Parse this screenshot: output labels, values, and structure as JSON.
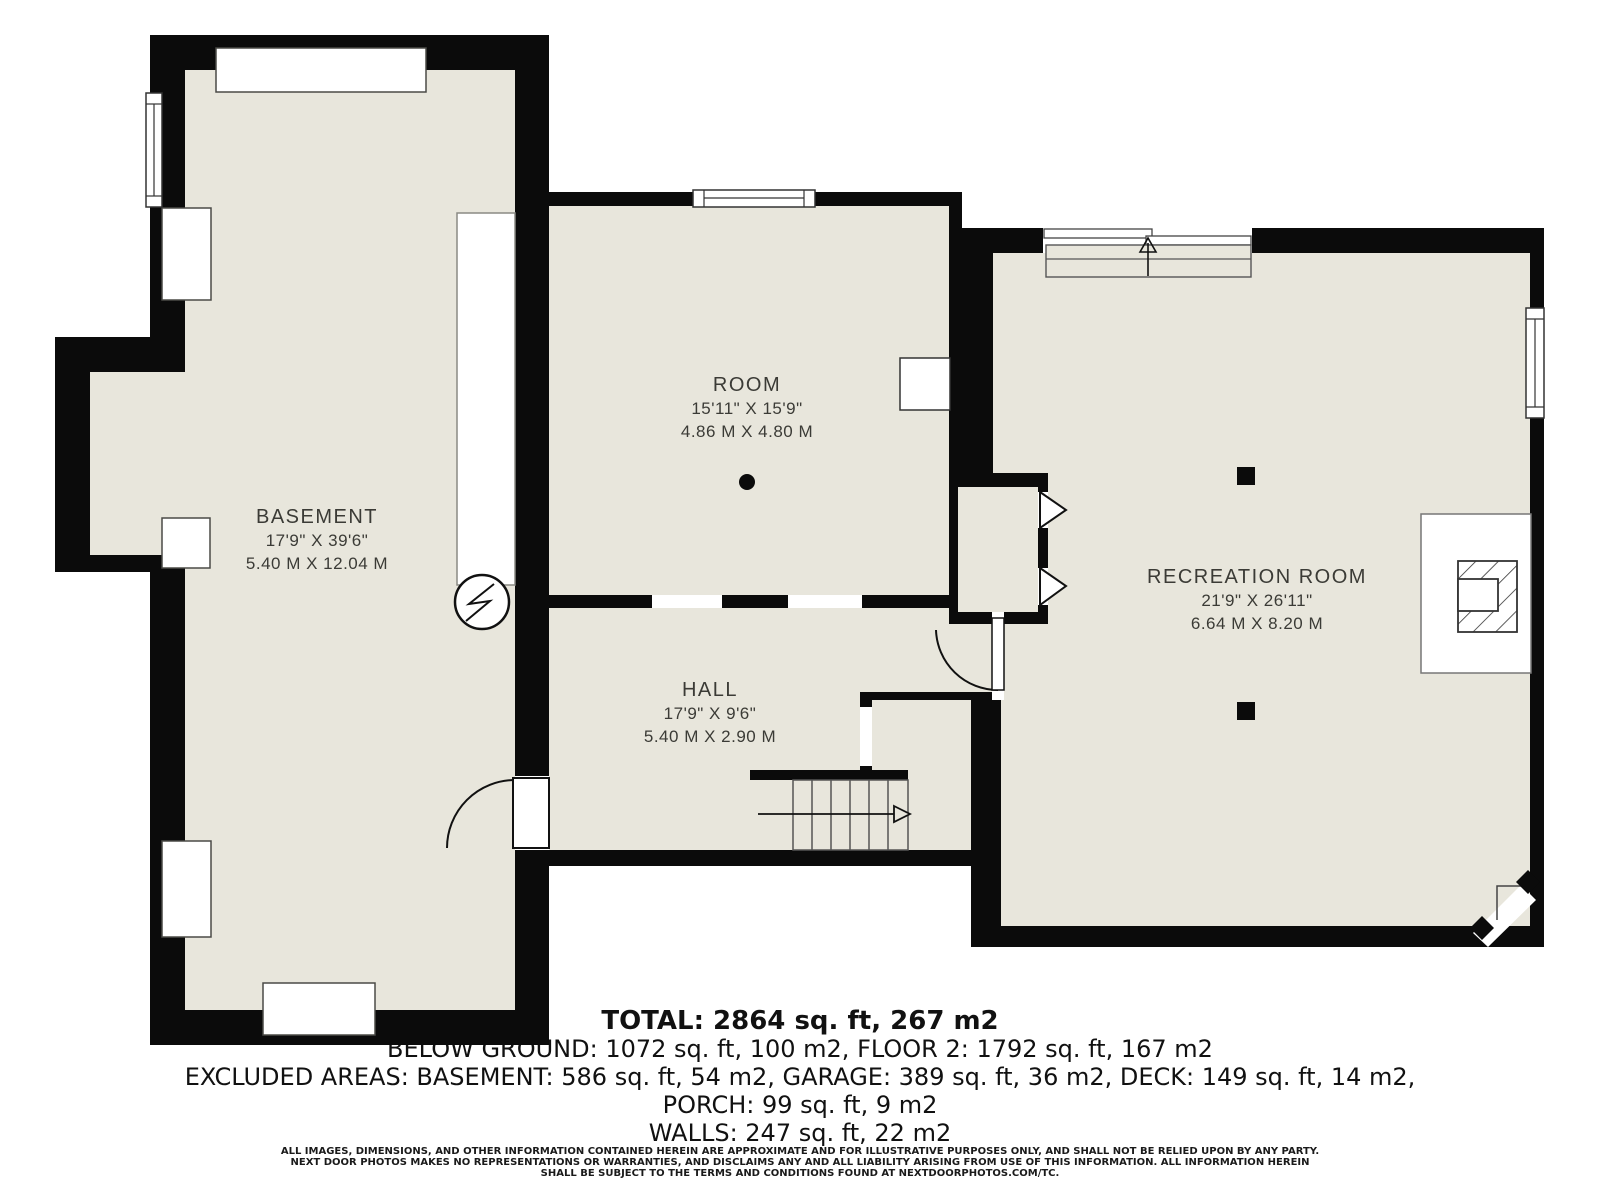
{
  "colors": {
    "floor": "#e8e6dc",
    "wall": "#0b0b0b",
    "background": "#ffffff"
  },
  "rooms": [
    {
      "name": "BASEMENT",
      "dims_ft": "17'9\" X 39'6\"",
      "dims_m": "5.40 M X 12.04 M"
    },
    {
      "name": "ROOM",
      "dims_ft": "15'11\" X 15'9\"",
      "dims_m": "4.86 M X 4.80 M"
    },
    {
      "name": "HALL",
      "dims_ft": "17'9\" X 9'6\"",
      "dims_m": "5.40 M X 2.90 M"
    },
    {
      "name": "RECREATION ROOM",
      "dims_ft": "21'9\" X 26'11\"",
      "dims_m": "6.64 M X 8.20 M"
    }
  ],
  "summary": {
    "total": "TOTAL: 2864 sq. ft, 267 m2",
    "below_ground": "BELOW GROUND: 1072 sq. ft, 100 m2, FLOOR 2: 1792 sq. ft, 167 m2",
    "excluded": "EXCLUDED AREAS: BASEMENT: 586 sq. ft, 54 m2, GARAGE: 389 sq. ft, 36 m2, DECK: 149 sq. ft, 14 m2,",
    "porch": "PORCH: 99 sq. ft, 9 m2",
    "walls": "WALLS: 247 sq. ft, 22 m2"
  },
  "disclaimer": {
    "line1": "ALL IMAGES, DIMENSIONS, AND OTHER INFORMATION CONTAINED HEREIN ARE APPROXIMATE AND FOR ILLUSTRATIVE PURPOSES ONLY, AND SHALL NOT BE RELIED UPON BY ANY PARTY.",
    "line2": "NEXT DOOR PHOTOS MAKES NO REPRESENTATIONS OR WARRANTIES, AND DISCLAIMS ANY AND ALL LIABILITY ARISING FROM USE OF THIS INFORMATION. ALL INFORMATION HEREIN",
    "line3": "SHALL BE SUBJECT TO THE TERMS AND CONDITIONS FOUND AT NEXTDOORPHOTOS.COM/TC."
  }
}
